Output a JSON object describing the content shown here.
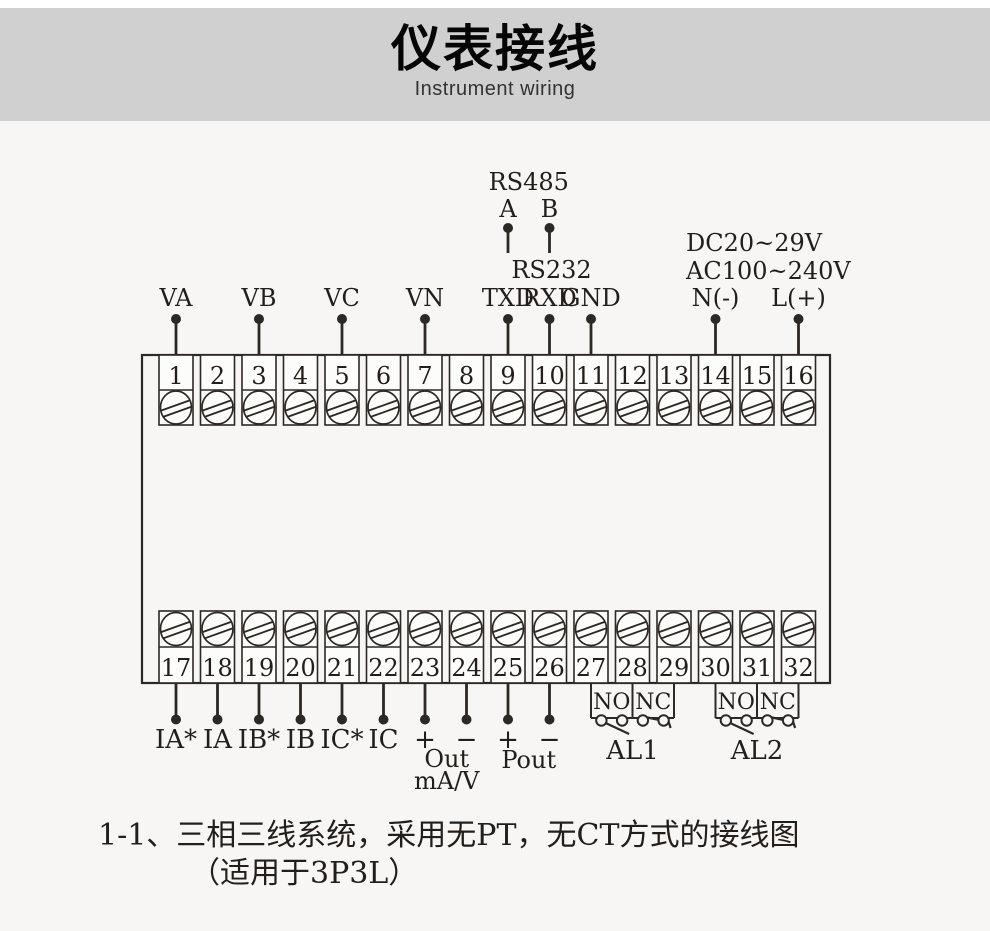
{
  "header": {
    "title": "仪表接线",
    "subtitle": "Instrument wiring"
  },
  "colors": {
    "banner": "#d1d0d0",
    "page": "#f7f6f5",
    "line": "#2e2824",
    "text": "#231e1a",
    "cell_fill": "#fcfcfb"
  },
  "diagram": {
    "rs485": {
      "title": "RS485",
      "pin_a_label": "A",
      "pin_b_label": "B",
      "pin_a_terminal": 9,
      "pin_b_terminal": 10
    },
    "rs232": {
      "title": "RS232"
    },
    "power_supply": {
      "line1": "DC20~29V",
      "line2": "AC100~240V"
    },
    "top_row_terminals": [
      1,
      2,
      3,
      4,
      5,
      6,
      7,
      8,
      9,
      10,
      11,
      12,
      13,
      14,
      15,
      16
    ],
    "bottom_row_terminals": [
      17,
      18,
      19,
      20,
      21,
      22,
      23,
      24,
      25,
      26,
      27,
      28,
      29,
      30,
      31,
      32
    ],
    "top_pins": [
      {
        "label": "VA",
        "terminal": 1
      },
      {
        "label": "VB",
        "terminal": 3
      },
      {
        "label": "VC",
        "terminal": 5
      },
      {
        "label": "VN",
        "terminal": 7
      },
      {
        "label": "TXD",
        "terminal": 9
      },
      {
        "label": "RXD",
        "terminal": 10
      },
      {
        "label": "GND",
        "terminal": 11
      },
      {
        "label": "N(-)",
        "terminal": 14
      },
      {
        "label": "L(+)",
        "terminal": 16
      }
    ],
    "bottom_pins": [
      {
        "label": "IA*",
        "terminal": 17
      },
      {
        "label": "IA",
        "terminal": 18
      },
      {
        "label": "IB*",
        "terminal": 19
      },
      {
        "label": "IB",
        "terminal": 20
      },
      {
        "label": "IC*",
        "terminal": 21
      },
      {
        "label": "IC",
        "terminal": 22
      },
      {
        "label": "+",
        "terminal": 23
      },
      {
        "label": "−",
        "terminal": 24
      },
      {
        "label": "+",
        "terminal": 25
      },
      {
        "label": "−",
        "terminal": 26
      }
    ],
    "analog_output": {
      "label": "Out",
      "unit": "mA/V"
    },
    "pulse_output": {
      "label": "Pout"
    },
    "relays": [
      {
        "label": "AL1",
        "no_label": "NO",
        "nc_label": "NC",
        "terminals": [
          27,
          28,
          29
        ]
      },
      {
        "label": "AL2",
        "no_label": "NO",
        "nc_label": "NC",
        "terminals": [
          30,
          31,
          32
        ]
      }
    ]
  },
  "caption": {
    "line1": "1-1、三相三线系统，采用无PT，无CT方式的接线图",
    "line2": "（适用于3P3L）"
  }
}
